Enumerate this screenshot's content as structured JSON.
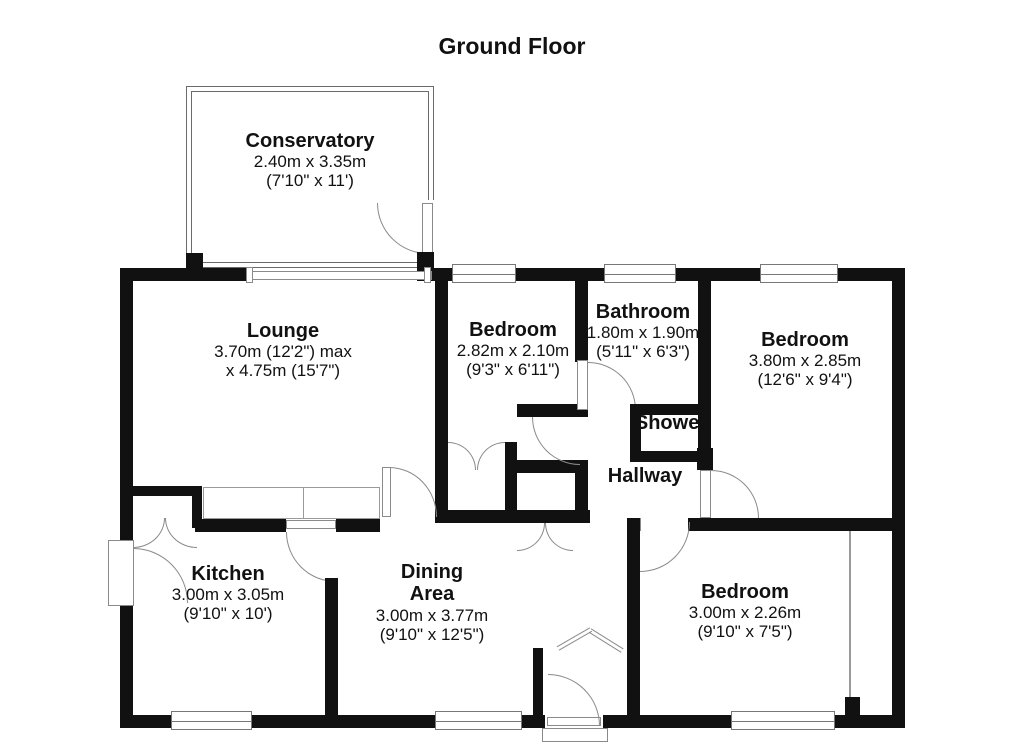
{
  "title": "Ground Floor",
  "rooms": [
    {
      "id": "conservatory",
      "name": "Conservatory",
      "metric": "2.40m x 3.35m",
      "imperial": "(7'10\" x 11')"
    },
    {
      "id": "lounge",
      "name": "Lounge",
      "metric": "3.70m (12'2\") max",
      "imperial": "x 4.75m (15'7\")"
    },
    {
      "id": "bedroom-1",
      "name": "Bedroom",
      "metric": "2.82m x 2.10m",
      "imperial": "(9'3\" x 6'11\")"
    },
    {
      "id": "bathroom",
      "name": "Bathroom",
      "metric": "1.80m x 1.90m",
      "imperial": "(5'11\" x 6'3\")"
    },
    {
      "id": "bedroom-2",
      "name": "Bedroom",
      "metric": "3.80m x 2.85m",
      "imperial": "(12'6\" x 9'4\")"
    },
    {
      "id": "kitchen",
      "name": "Kitchen",
      "metric": "3.00m x 3.05m",
      "imperial": "(9'10\" x 10')"
    },
    {
      "id": "dining-area",
      "name_line1": "Dining",
      "name_line2": "Area",
      "metric": "3.00m x 3.77m",
      "imperial": "(9'10\" x 12'5\")"
    },
    {
      "id": "bedroom-3",
      "name": "Bedroom",
      "metric": "3.00m x 2.26m",
      "imperial": "(9'10\" x 7'5\")"
    }
  ],
  "areas": {
    "shower": "Shower",
    "hallway": "Hallway"
  },
  "colors": {
    "wall": "#111111",
    "line": "#8a8a8a",
    "text": "#111111"
  }
}
